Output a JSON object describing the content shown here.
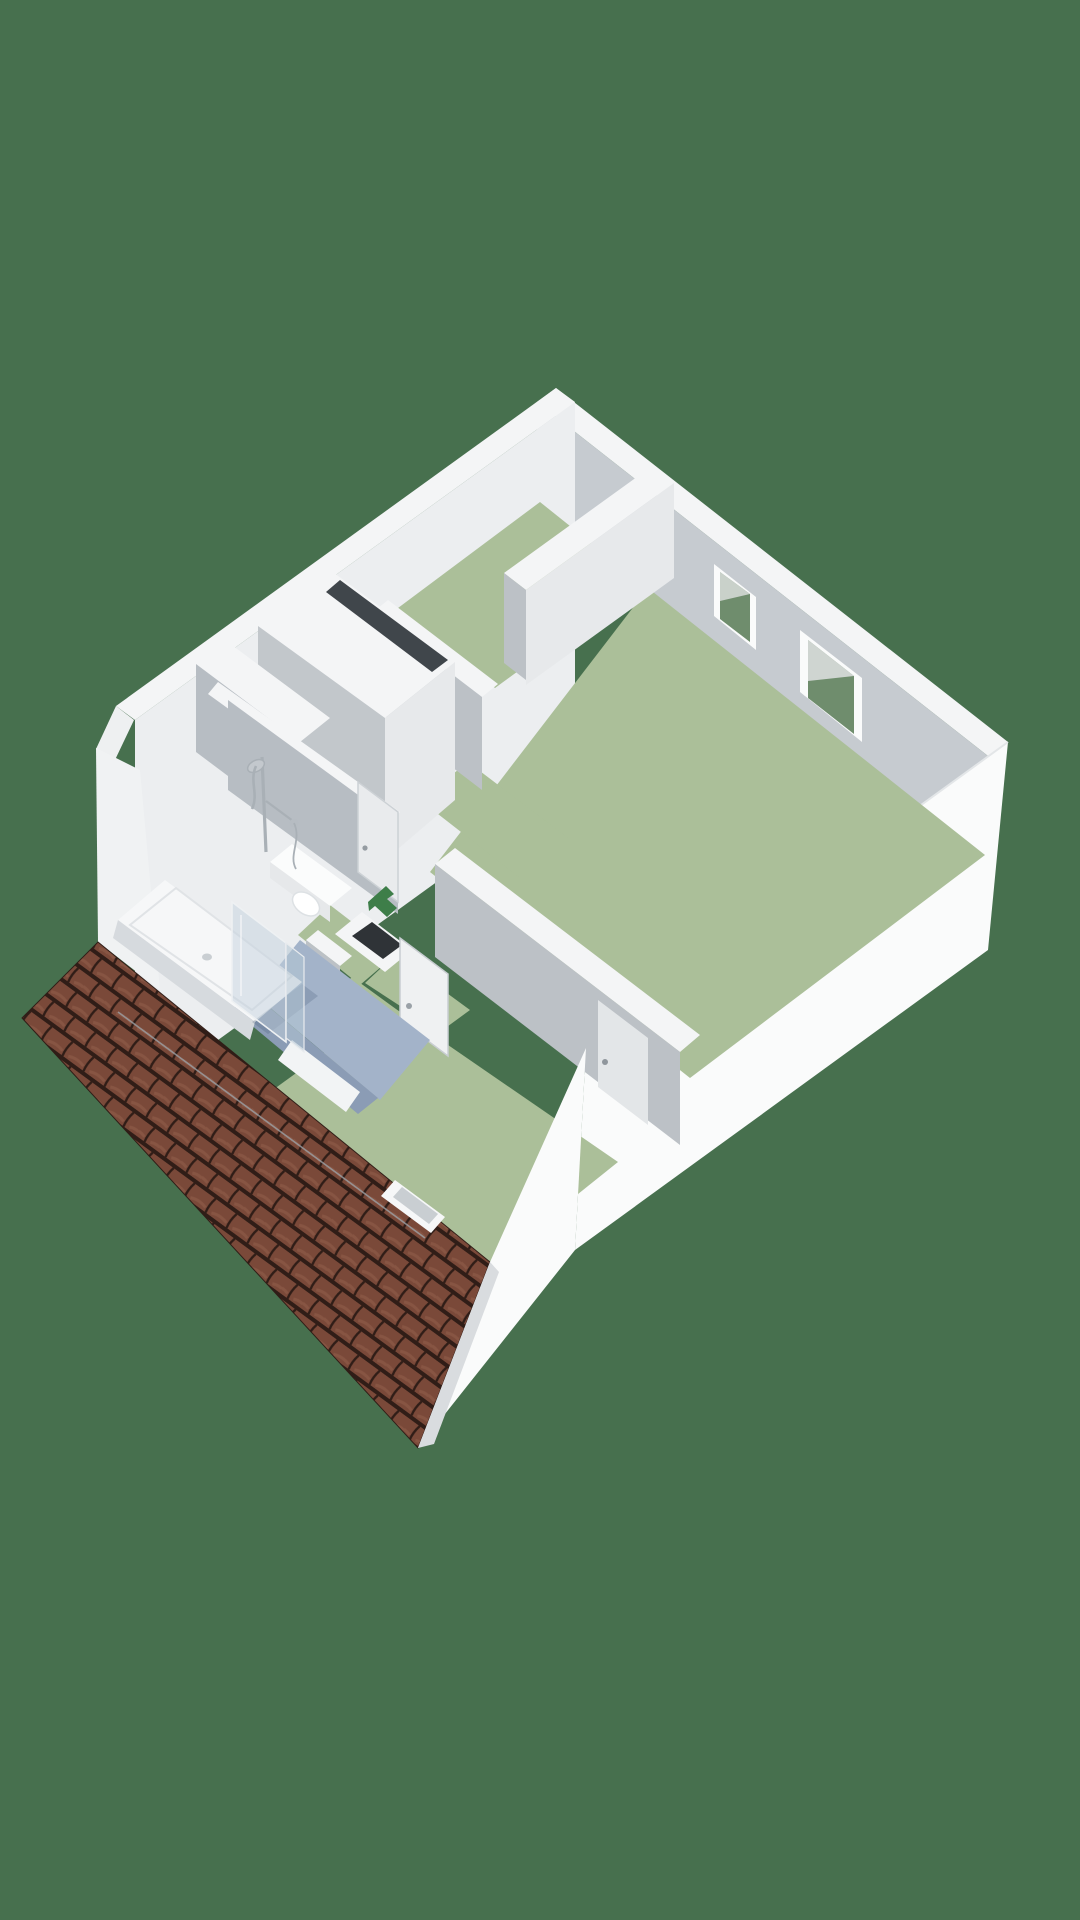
{
  "meta": {
    "app": "floorplan-3d-viewer",
    "view": "isometric-3d-floorplan",
    "storey": "attic-floor",
    "visible_text": ""
  },
  "colors": {
    "background": "#47704e",
    "wallTop": "#f4f5f6",
    "wallOuter": "#fafbfb",
    "wallChamfer": "#eef0f1",
    "wallInnerLight": "#eceef0",
    "wallInnerMid": "#e7e9eb",
    "wallInnerSoft": "#dfe2e5",
    "wallInnerGray": "#bcc1c6",
    "wallFaceGray": "#b7bdc3",
    "closetGray": "#c2c7cb",
    "floorGreen": "#abbf99",
    "bathFloor": "#a3b3c9",
    "bathFloorDark": "#8b9cb5",
    "glassGreen": "#6f8d6d",
    "glassLight": "#d9dddb",
    "roofBase": "#6a4134",
    "roofTile": "#7b4a3a",
    "roofDark": "#2e1c16",
    "roofHi": "#95604d",
    "roofLine": "#9ba1a6",
    "slotDark": "#40464b",
    "shaftDark": "#2f3337",
    "arrowGreen": "#3e7e49",
    "chrome": "#a9b0b6",
    "chromeLight": "#c3c8cd",
    "doorWhite": "#eff1f2",
    "doorOnGray": "#e3e6e8",
    "tubWhite": "#f6f7f8",
    "tubSide": "#d6dade",
    "toiletWhite": "#fbfcfc",
    "thresholdWhite": "#f2f4f5",
    "gableShade": "#d9dcdf",
    "glassPane": "rgba(195,210,222,0.5)",
    "glassPane2": "rgba(180,198,212,0.55)",
    "shadowBlue": "rgba(60,80,110,0.22)"
  },
  "scene": {
    "rooms": [
      {
        "name": "bedroom-top",
        "floor": "green"
      },
      {
        "name": "bedroom-right",
        "floor": "green"
      },
      {
        "name": "bedroom-bottom",
        "floor": "green"
      },
      {
        "name": "hallway-landing",
        "floor": "green"
      },
      {
        "name": "bathroom",
        "floor": "blue-gray"
      }
    ],
    "fixtures": [
      "bathtub",
      "shower-screen",
      "shower-fixture",
      "toilet",
      "staircase-opening",
      "duct-shaft",
      "skylight-frame",
      "window-small",
      "window-large",
      "direction-arrow",
      "tiled-roof",
      "gable-wall"
    ]
  }
}
